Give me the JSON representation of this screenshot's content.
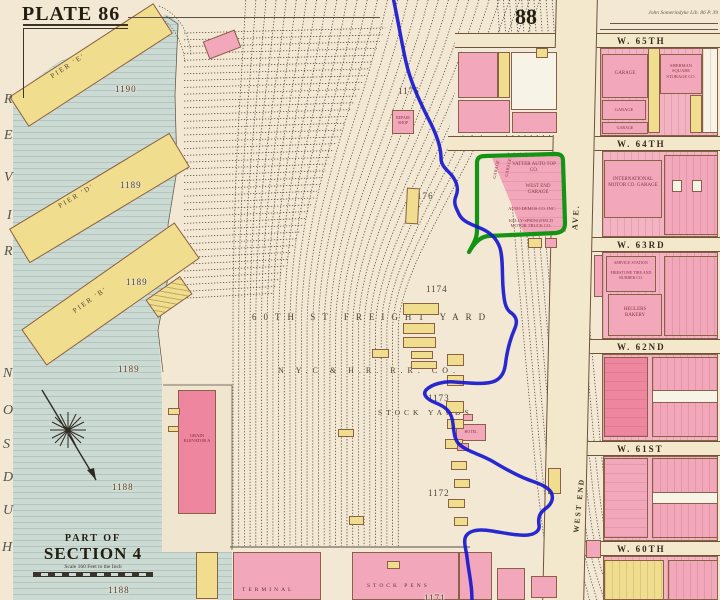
{
  "header": {
    "plate_label": "PLATE 86",
    "page_number": "88",
    "survey_note": "John Somerindyke  Lib. 86 P. 39"
  },
  "river": {
    "name": "HUDSON RIVER",
    "letters_top_to_bottom": [
      "R",
      "E",
      "V",
      "I",
      "R",
      "N",
      "O",
      "S",
      "D",
      "U",
      "H"
    ]
  },
  "section_note": {
    "line1": "PART OF",
    "line2": "SECTION 4",
    "scale": "Scale 160 Feet to the Inch"
  },
  "piers": [
    {
      "label": "PIER 'E'",
      "number": "1190"
    },
    {
      "label": "PIER 'D'",
      "number": "1189"
    },
    {
      "label": "PIER 'B'",
      "number": "1189"
    }
  ],
  "water_numbers": {
    "n1": "1189",
    "n2": "1188",
    "n3": "1188"
  },
  "yard": {
    "title": "60TH ST FREIGHT YARD",
    "owner": "N.Y.C & H.R. R.R. CO.",
    "stock_yards": "STOCK YARDS",
    "numbers": {
      "n1175": "1175",
      "n1176": "1176",
      "n1174": "1174",
      "n1173": "1173",
      "n1172": "1172",
      "n1171": "1171"
    }
  },
  "buildings": {
    "grain_elevator": "GRAIN ELEVATOR A",
    "terminal": "TERMINAL",
    "stock_pens": "STOCK PENS",
    "hotel": "HOTEL",
    "repair_shop": "REPAIR SHOP"
  },
  "avenue": {
    "upper": "AVE.",
    "lower": "WEST END"
  },
  "streets": [
    "W. 65TH",
    "W. 64TH",
    "W. 63RD",
    "W. 62ND",
    "W. 61ST",
    "W. 60TH"
  ],
  "highlight_block": {
    "l1": "VATTER AUTO TOP CO.",
    "l2": "WEST END GARAGE",
    "l3": "AUTO DEMOS CO. INC.",
    "l4": "KELLY-SPRINGFIELD MOTOR TRUCK CO.",
    "l5": "GARAGE",
    "l6": "GARAGE"
  },
  "east_blocks": {
    "b1a": "GARAGE",
    "b1b": "SHERMAN SQUARE STORAGE CO.",
    "b1c": "GARAGE",
    "b1d": "GARAGE",
    "b2": "INTERNATIONAL MOTOR CO. GARAGE",
    "b3a": "SERVICE STATION",
    "b3b": "FIRESTONE TIRE AND RUBBER CO.",
    "b3c": "HEGLERS BAKERY"
  },
  "annotations": {
    "route_color": "#1717cf",
    "highlight_color": "#149414"
  }
}
